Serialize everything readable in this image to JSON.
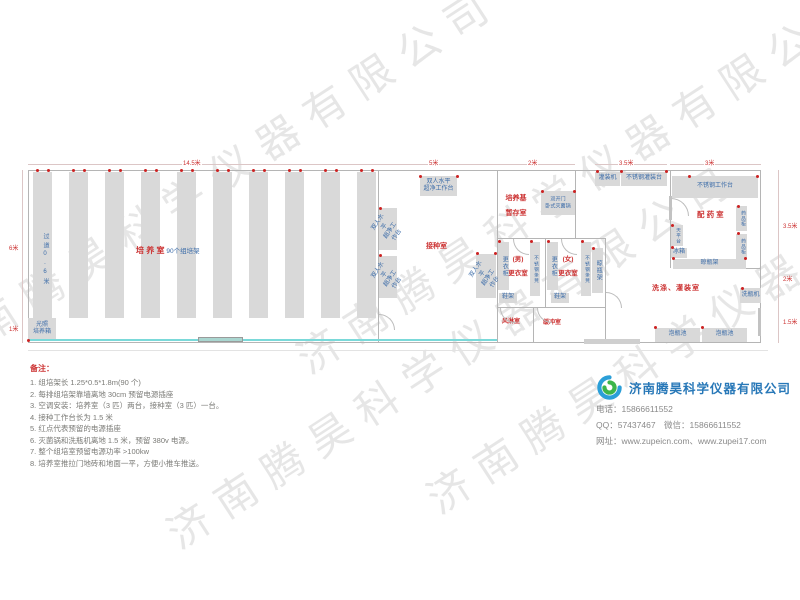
{
  "watermark": {
    "text": "济南腾昊科学仪器有限公司"
  },
  "plan": {
    "dims": {
      "top_culture": "14.5米",
      "top_inoculation": "5米",
      "top_storage": "2米",
      "top_filling": "3.5米",
      "top_pharmacy": "3米",
      "left_main": "6米",
      "left_bottom": "1米",
      "right_top": "3.5米",
      "right_mid": "2米",
      "right_bottom": "1.5米"
    },
    "culture": {
      "name": "培 养 室",
      "racks": "90个组培架",
      "aisle": "过道0.6米",
      "incubator": "光照\n培养箱"
    },
    "inoculation": {
      "name": "接种室",
      "bench": "双人水平\n超净工作台"
    },
    "storage": {
      "name": "培养基\n暂存室",
      "sterilizer": "双开门\n卧式灭菌锅"
    },
    "changing": {
      "locker": "更衣柜",
      "bench": "不锈钢条凳",
      "male": "(男)\n更衣室",
      "female": "(女)\n更衣室",
      "shoe_rack": "鞋架",
      "air_shower": "风淋室",
      "buffer": "缓冲室",
      "bottle_rack": "晾瓶架"
    },
    "pharmacy": {
      "name": "配 药 室",
      "filling_machine": "灌装机",
      "filling_table": "不锈钢灌装台",
      "work_table": "不锈钢工作台",
      "balance": "天平台",
      "fridge": "冰箱",
      "cabinet": "药品柜",
      "bottle_rack": "晾瓶架"
    },
    "washing": {
      "name": "洗涤、灌装室",
      "washer": "洗瓶机",
      "pool": "泡瓶池"
    }
  },
  "notes": {
    "title": "备注：",
    "items": [
      "1.  组培架长 1.25*0.5*1.8m(90 个)",
      "2.  每排组培架靠墙离地 30cm 预留电源插座",
      "3.  空调安装：培养室（3 匹）两台，接种室（3 匹）一台。",
      "4.  接种工作台长为 1.5 米",
      "5.  红点代表预留的电源插座",
      "6.  灭菌锅和洗瓶机离地 1.5 米，预留 380v 电源。",
      "7.  整个组培室预留电源功率 >100kw",
      "8.  培养室推拉门地砖和地面一平，方便小推车推送。"
    ]
  },
  "company": {
    "name": "济南腾昊科学仪器有限公司",
    "phone": "电话：15866611552",
    "qq_wechat": "QQ：57437467　微信：15866611552",
    "website": "网址：www.zupeicn.com、www.zupei17.com"
  }
}
